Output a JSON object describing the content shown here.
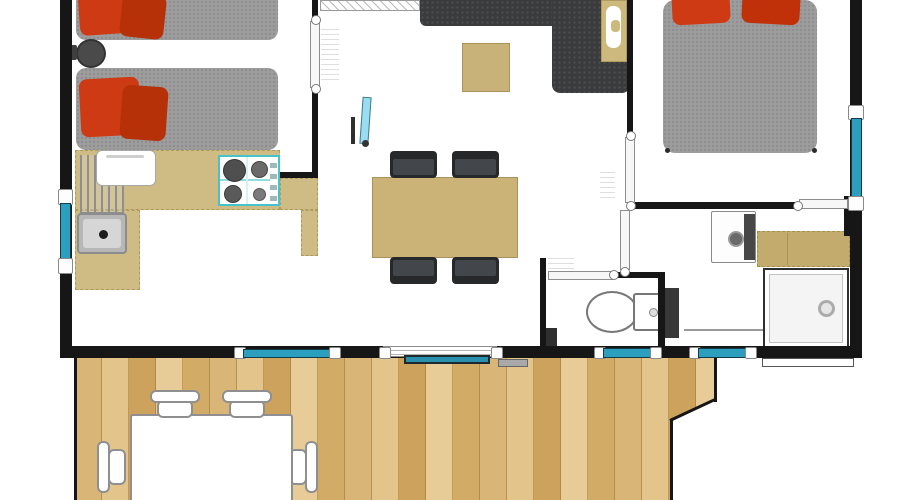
{
  "plan": {
    "type": "floor-plan",
    "scene": "mobile-home top-down plan with wooden deck",
    "palette": {
      "wall": "#161616",
      "window_glass": "#2b9fbd",
      "sliding_glass": "#2b8fae",
      "counter_tan": "#cfbc85",
      "dining_table_tan": "#cbb378",
      "coffee_table_tan": "#c9b279",
      "bathroom_counter_tan": "#c3aa6d",
      "mattress_gray": "#9d9d9d",
      "sofa_gray": "#3a3b3d",
      "dining_chair_gray": "#26282a",
      "pillow_red": "#ce3a13",
      "pillow_red_dark": "#b63008",
      "deck_wood": "#d8b272",
      "tv_screen": "#9adcf0",
      "stove_accent": "#45c3cb",
      "floor": "#ffffff"
    },
    "rooms": {
      "bedroom_twin": {
        "label": "Twin bedroom",
        "items": [
          "single-bed",
          "single-bed",
          "bedside-stool"
        ]
      },
      "kitchen": {
        "label": "Kitchen",
        "items": [
          "l-shaped-counter",
          "gas-hob-4-burners",
          "sink",
          "dish-rack",
          "small-appliance"
        ]
      },
      "living_dining": {
        "label": "Living / dining room",
        "items": [
          "corner-sofa",
          "corner-side-table",
          "coffee-table",
          "tv",
          "wall-shelf",
          "dining-table",
          "dining-chair x4"
        ]
      },
      "bedroom_double": {
        "label": "Double bedroom",
        "items": [
          "double-bed",
          "pillow x2"
        ]
      },
      "wc": {
        "label": "WC",
        "items": [
          "toilet",
          "wall-cabinet"
        ]
      },
      "bathroom": {
        "label": "Shower room",
        "items": [
          "washbasin",
          "vanity-counter",
          "shower"
        ]
      },
      "deck": {
        "label": "Wooden deck",
        "items": [
          "outdoor-table",
          "outdoor-chair x4"
        ]
      }
    },
    "openings": {
      "windows": [
        "left-wall-window",
        "right-wall-window",
        "bottom-wall-window-1",
        "bottom-wall-window-2",
        "bottom-wall-window-3",
        "sliding-bay-door"
      ],
      "doors": [
        "bedroom-twin-door",
        "bedroom-double-door",
        "bathroom-door",
        "wc-door"
      ]
    }
  }
}
